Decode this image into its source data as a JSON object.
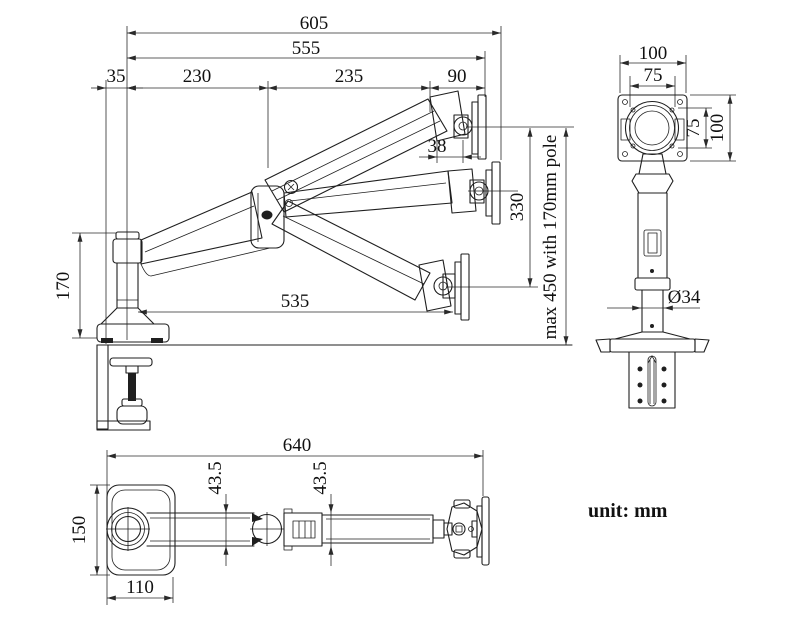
{
  "unit_label": "unit: mm",
  "colors": {
    "line": "#1f1f1f",
    "dimension": "#2a2a2a",
    "background": "#ffffff"
  },
  "side_view": {
    "title": "side-elevation-view",
    "dims": {
      "total_width": "605",
      "vesa_width": "555",
      "clamp_offset": "35",
      "arm1_span": "230",
      "arm2_span": "235",
      "head_span": "90",
      "head_depth": "38",
      "vesa_travel": "330",
      "pole_height": "170",
      "low_reach": "535",
      "lift_note": "max 450 with 170mm pole"
    }
  },
  "front_view": {
    "title": "front-view",
    "dims": {
      "plate_width": "100",
      "vesa_hole_width": "75",
      "vesa_hole_height": "75",
      "plate_height": "100",
      "pole_diameter": "Ø34"
    }
  },
  "top_view": {
    "title": "top-plan-view",
    "dims": {
      "total_length": "640",
      "arm1_width": "43.5",
      "arm2_width": "43.5",
      "base_depth": "150",
      "base_width": "110"
    }
  }
}
